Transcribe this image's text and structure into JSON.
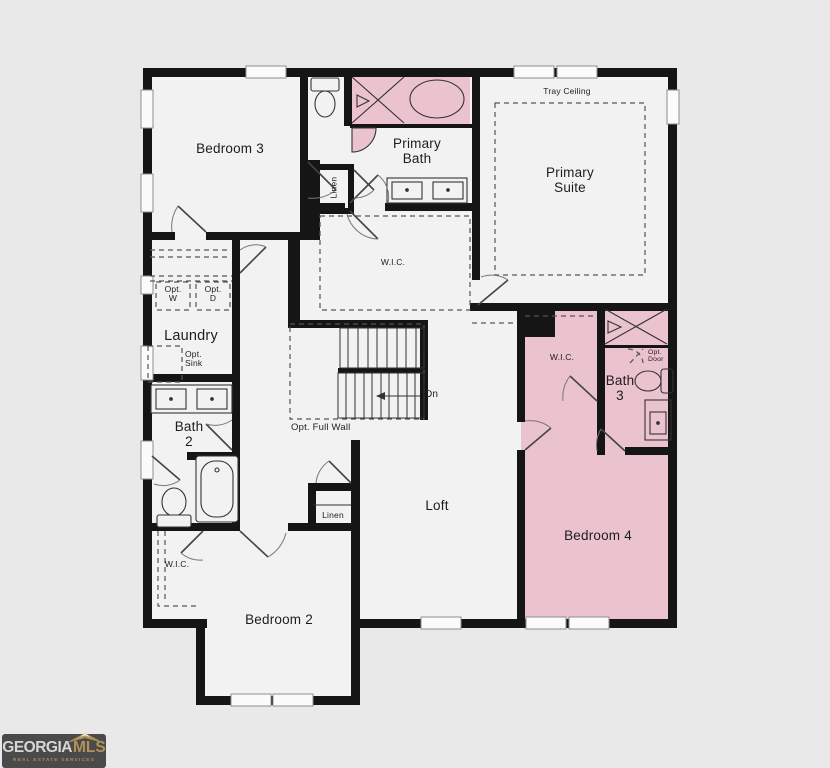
{
  "plan": {
    "labels": {
      "bedroom3": "Bedroom 3",
      "primary_bath": "Primary Bath",
      "tray_ceiling": "Tray Ceiling",
      "primary_suite": "Primary Suite",
      "linen_primary": "Linen",
      "wic_primary": "W.I.C.",
      "laundry": "Laundry",
      "opt_w": "Opt. W",
      "opt_d": "Opt. D",
      "opt_sink": "Opt. Sink",
      "bath2": "Bath 2",
      "opt_full_wall": "Opt. Full Wall",
      "down": "Dn",
      "loft": "Loft",
      "wic_bed2": "W.I.C.",
      "linen_hall": "Linen",
      "bedroom2": "Bedroom 2",
      "wic_suite": "W.I.C.",
      "bath3": "Bath 3",
      "opt_door": "Opt. Door",
      "bedroom4": "Bedroom 4"
    },
    "colors": {
      "background": "#e9e9e9",
      "room_fill": "#f2f2f2",
      "wall": "#151515",
      "highlight_pink": "#eac3cf",
      "dashed_line": "#555555"
    }
  },
  "logo": {
    "brand_primary": "GEORGIA",
    "brand_secondary": "MLS",
    "tagline": "REAL ESTATE SERVICES"
  }
}
